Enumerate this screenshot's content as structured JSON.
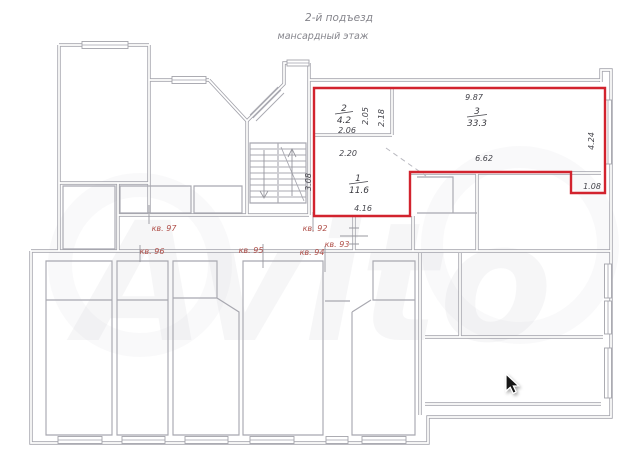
{
  "header": {
    "line1": "2-й подъезд",
    "line2": "мансардный этаж"
  },
  "watermark": {
    "text": "Avito"
  },
  "colors": {
    "highlight_red": "#d2232e",
    "apartment_label_red": "#b0504a",
    "wall_gray": "#a3a3ab",
    "dimension_text": "#45454c"
  },
  "apartments": [
    {
      "label": "кв. 92"
    },
    {
      "label": "кв. 93"
    },
    {
      "label": "кв. 94"
    },
    {
      "label": "кв. 95"
    },
    {
      "label": "кв. 96"
    },
    {
      "label": "кв. 97"
    }
  ],
  "highlighted_unit": {
    "rooms": [
      {
        "number": "1",
        "area": "11.6"
      },
      {
        "number": "2",
        "area": "4.2"
      },
      {
        "number": "3",
        "area": "33.3"
      }
    ],
    "dimensions": {
      "room3_top_width": "9.87",
      "room2_left_height": "2.05",
      "room3_left_height": "2.18",
      "room2_bottom_width": "2.06",
      "room1_top_width": "2.20",
      "room1_left_height": "3.08",
      "room1_bottom_width": "4.16",
      "room3_bottom_width": "6.62",
      "room3_right_height": "4.24",
      "notch_width": "1.08"
    }
  }
}
